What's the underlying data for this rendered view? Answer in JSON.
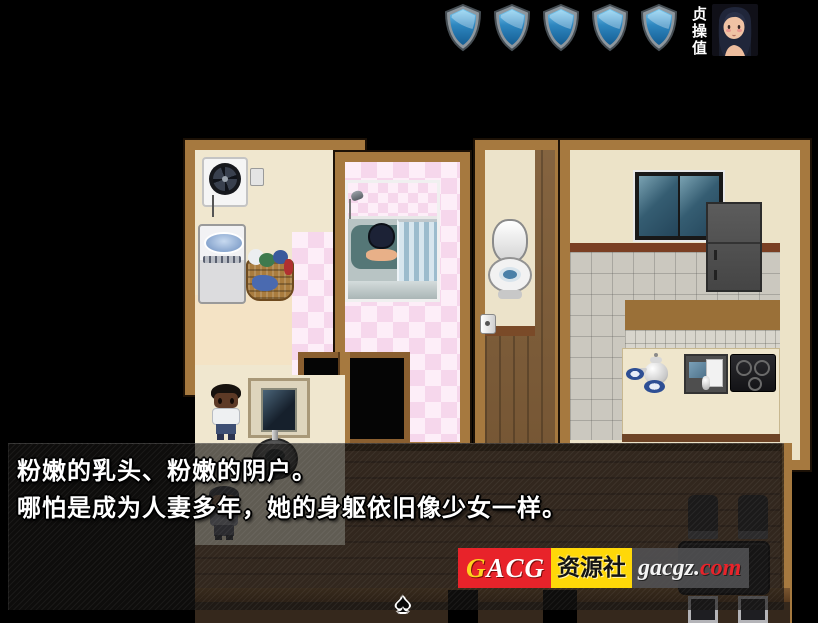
{
  "hud": {
    "stat_label": "贞操值",
    "shields": {
      "count": 5,
      "fill": "#2e86bf",
      "rim": "#8e979e"
    },
    "portrait": "woman-portrait"
  },
  "dialogue": {
    "lines": [
      "粉嫩的乳头、粉嫩的阴户。",
      "哪怕是成为人妻多年，她的身躯依旧像少女一样。"
    ],
    "continue_indicator": "♠"
  },
  "watermark": {
    "brand_first_letter": "G",
    "brand_rest": "ACG",
    "brand_middle": "资源社",
    "domain_white": "gacgz.",
    "domain_red": "com",
    "red": "#e8232a",
    "yellow": "#ffd808"
  },
  "scene": {
    "rooms": [
      "laundry-room",
      "bathroom",
      "toilet-room",
      "kitchen",
      "hallway",
      "dining-room"
    ],
    "objects": [
      "exhaust-fan",
      "power-outlet",
      "washing-machine",
      "laundry-basket",
      "bathtub",
      "shower-head",
      "shower-curtain",
      "toilet",
      "toilet-paper",
      "corridor-door",
      "window",
      "refrigerator",
      "tea-kettle",
      "teacup",
      "kitchen-sink",
      "stove",
      "washstand-mirror",
      "wash-basin",
      "dining-table",
      "chair"
    ],
    "characters": [
      "bathing-woman",
      "boy-standing",
      "man-in-hallway"
    ]
  }
}
